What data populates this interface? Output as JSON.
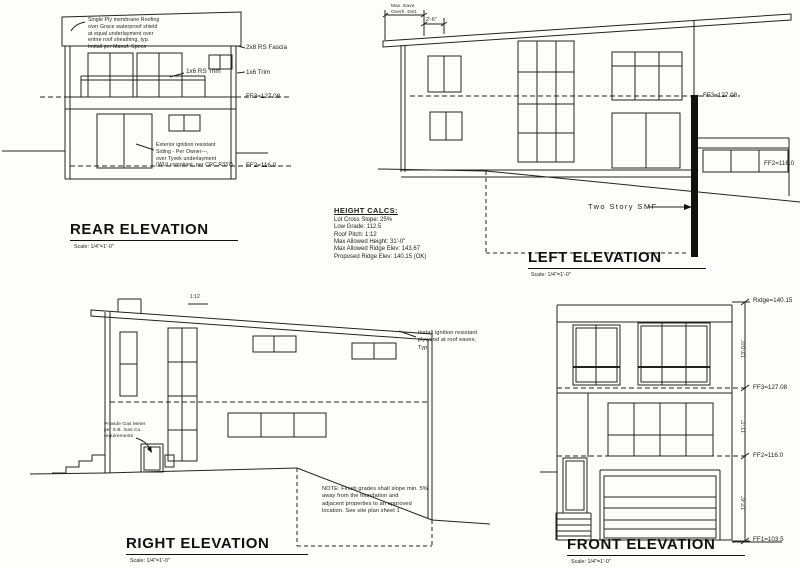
{
  "sheet": {
    "background": "#fdfdfb",
    "ink": "#1c1c1c"
  },
  "height_calcs": {
    "title": "HEIGHT CALCS:",
    "lines": [
      "Lot Cross Slope: 25%",
      "Low Grade: 112.5",
      "Roof Pitch: 1:12",
      "Max Allowed Height: 31'-0\"",
      "Max Allowed Ridge Elev: 143.67",
      "Proposed Ridge Elev: 140.15 (OK)"
    ]
  },
  "rear": {
    "title": "REAR ELEVATION",
    "scale": "Scale: 1/4\"=1'-0\"",
    "roof_note": "Single Ply membrane Roofing\nover Grace waterproof shield\nat equal underlayment over\nentire roof sheathing, typ.\nInstall per Manuf. Specs",
    "siding_note": "Exterior ignition resistant\nSiding - Per Owner---,\nover Tyvek underlayment\n(WUI compliant, per CRC R337)",
    "fascia_label": "2x8 RS Fascia",
    "trim_label": "1x6 Trim",
    "rail_label": "1x6 RS Trim",
    "ff3_label": "FF3=127.08",
    "ff2_label": "FF2=116.0"
  },
  "left": {
    "title": "LEFT ELEVATION",
    "scale": "Scale: 1/4\"=1'-0\"",
    "eave_note": "Max. Eave\nOverh. Dist.",
    "eave_dim": "2'-6\"",
    "ff3_label": "FF3=127.08",
    "ff2_label": "FF2=116.0",
    "smf_label": "Two Story SMF"
  },
  "right": {
    "title": "RIGHT ELEVATION",
    "scale": "Scale: 1/4\"=1'-0\"",
    "pitch_label": "1:12",
    "eave_note": "Install ignition resistant\nplywood at roof eaves,\nTyp.",
    "meter_note": "Provide Gas Meter\nper S.B. Gas Co.\nrequirements",
    "grade_note": "NOTE:  Finish grades shall slope min. 5%\naway from the foundation and\nadjacent properties to an approved\nlocation.  See site plan sheet 1"
  },
  "front": {
    "title": "FRONT ELEVATION",
    "scale": "Scale: 1/4\"=1'-0\"",
    "ridge_label": "Ridge=140.15",
    "ff3_label": "FF3=127.08",
    "ff2_label": "FF2=116.0",
    "ff1_label": "FF1=103.5",
    "dim_upper": "13'-0⅞\"",
    "dim_mid": "11'-1\"",
    "dim_lower": "12'-6\""
  }
}
